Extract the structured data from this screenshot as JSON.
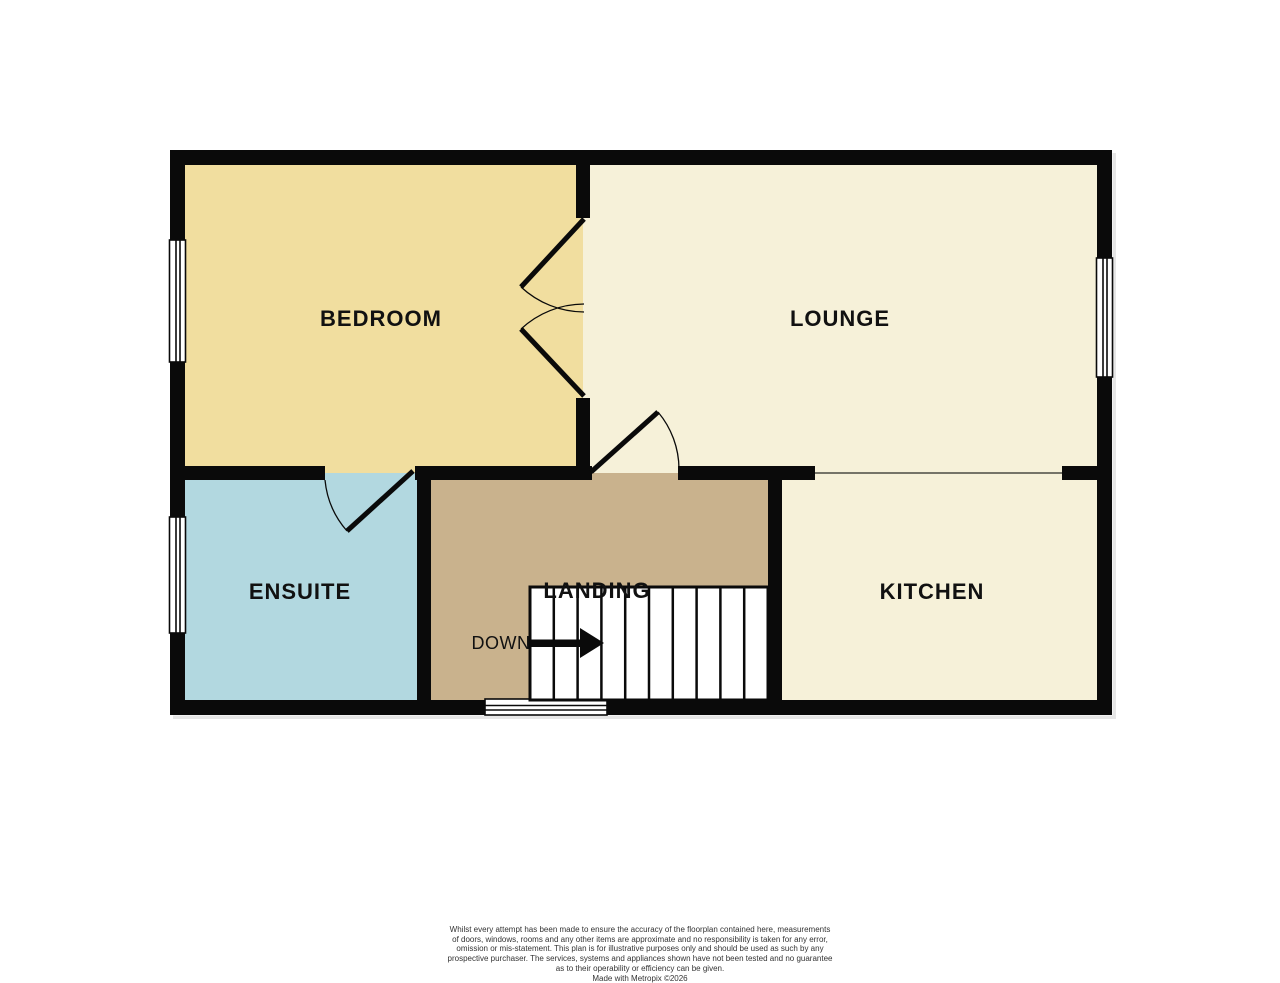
{
  "plan": {
    "rooms": [
      {
        "id": "bedroom",
        "label": "BEDROOM"
      },
      {
        "id": "lounge",
        "label": "LOUNGE"
      },
      {
        "id": "ensuite",
        "label": "ENSUITE"
      },
      {
        "id": "landing",
        "label": "LANDING"
      },
      {
        "id": "kitchen",
        "label": "KITCHEN"
      }
    ],
    "stairs": {
      "label": "DOWN",
      "treads": 10,
      "direction": "right"
    }
  },
  "colors": {
    "background": "#ffffff",
    "wall": "#0a0a0a",
    "bedroom": "#f1de9f",
    "lounge": "#f6f1d9",
    "kitchen": "#f6f1d9",
    "ensuite": "#b2d8e0",
    "landing": "#c9b28d",
    "window": "#ffffff",
    "divider": "#4a4a42",
    "label_text": "#111111"
  },
  "footer": {
    "disclaimer_lines": [
      "Whilst every attempt has been made to ensure the accuracy of the floorplan contained here, measurements",
      "of doors, windows, rooms and any other items are approximate and no responsibility is taken for any error,",
      "omission or mis-statement. This plan is for illustrative purposes only and should be used as such by any",
      "prospective purchaser. The services, systems and appliances shown have not been tested and no guarantee",
      "as to their operability or efficiency can be given.",
      "Made with Metropix ©2026"
    ]
  }
}
